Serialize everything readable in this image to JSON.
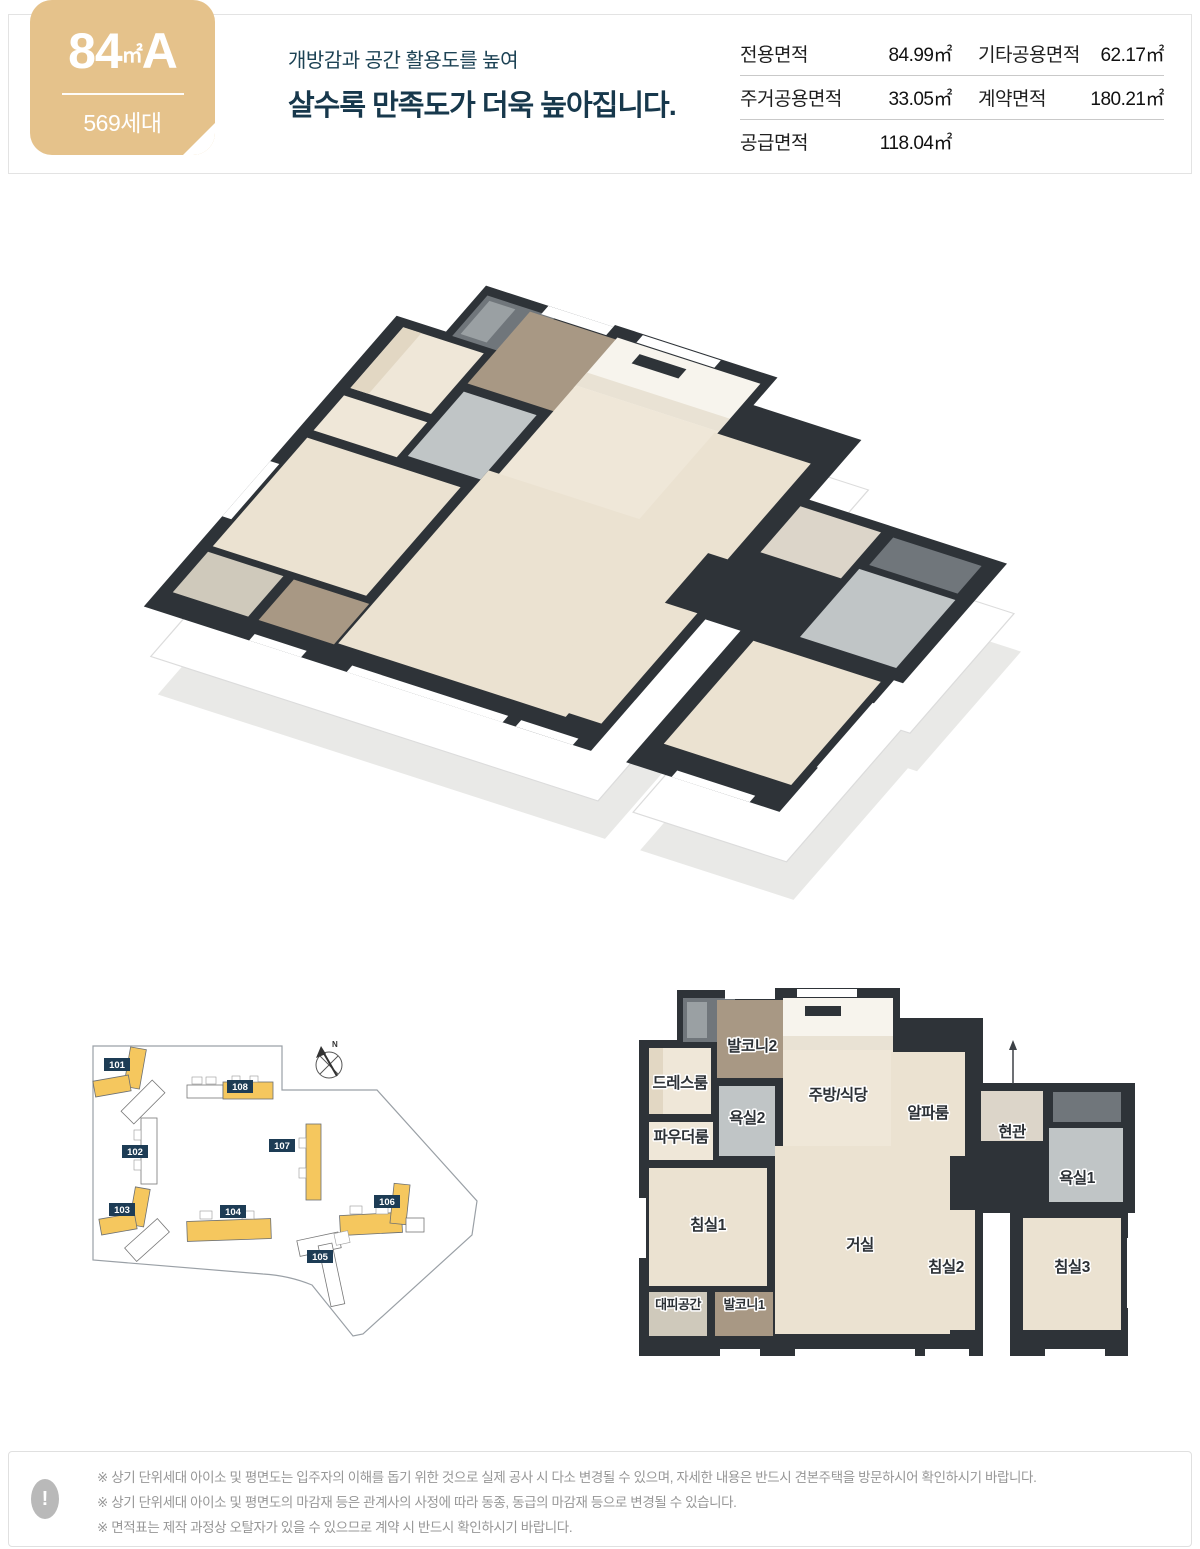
{
  "badge": {
    "area": "84",
    "unit": "㎡",
    "type_label": "A",
    "households": "569세대",
    "bg_color": "#e5c28b"
  },
  "header": {
    "subtitle": "개방감과 공간 활용도를 높여",
    "title": "살수록 만족도가 더욱 높아집니다.",
    "text_color": "#17384c"
  },
  "area_table": {
    "rows": [
      {
        "c1": {
          "label": "전용면적",
          "value": "84.99㎡"
        },
        "c2": {
          "label": "기타공용면적",
          "value": "62.17㎡"
        }
      },
      {
        "c1": {
          "label": "주거공용면적",
          "value": "33.05㎡"
        },
        "c2": {
          "label": "계약면적",
          "value": "180.21㎡"
        }
      },
      {
        "c1": {
          "label": "공급면적",
          "value": "118.04㎡"
        },
        "c2": {
          "label": "",
          "value": ""
        }
      }
    ]
  },
  "floor_plan": {
    "rooms": [
      {
        "label": "드레스룸"
      },
      {
        "label": "발코니2"
      },
      {
        "label": "주방/식당"
      },
      {
        "label": "알파룸"
      },
      {
        "label": "현관"
      },
      {
        "label": "욕실1"
      },
      {
        "label": "욕실2"
      },
      {
        "label": "파우더룸"
      },
      {
        "label": "침실1"
      },
      {
        "label": "거실"
      },
      {
        "label": "침실2"
      },
      {
        "label": "침실3"
      },
      {
        "label": "대피공간"
      },
      {
        "label": "발코니1"
      }
    ]
  },
  "site_plan": {
    "compass": "N",
    "buildings": [
      {
        "id": "101",
        "highlighted": true
      },
      {
        "id": "102",
        "highlighted": false
      },
      {
        "id": "103",
        "highlighted": true
      },
      {
        "id": "104",
        "highlighted": true
      },
      {
        "id": "105",
        "highlighted": false
      },
      {
        "id": "106",
        "highlighted": true
      },
      {
        "id": "107",
        "highlighted": true
      },
      {
        "id": "108",
        "highlighted": true
      }
    ]
  },
  "footer": {
    "icon": "!",
    "notes": [
      "※ 상기 단위세대 아이소 및 평면도는 입주자의 이해를 돕기 위한 것으로 실제 공사 시 다소 변경될 수 있으며, 자세한 내용은 반드시 견본주택을 방문하시어 확인하시기 바랍니다.",
      "※ 상기 단위세대 아이소 및 평면도의 마감재 등은 관계사의 사정에 따라 동종, 동급의 마감재 등으로 변경될 수 있습니다.",
      "※ 면적표는 제작 과정상 오탈자가 있을 수 있으므로 계약 시 반드시 확인하시기 바랍니다."
    ]
  },
  "colors": {
    "badge_bg": "#e5c28b",
    "navy": "#1d3c55",
    "wall": "#2e3338",
    "wood_floor": "#ebe2d1",
    "highlight_yellow": "#f5c75e",
    "tile_brown": "#a89884",
    "tile_bath": "#c0c5c6"
  }
}
